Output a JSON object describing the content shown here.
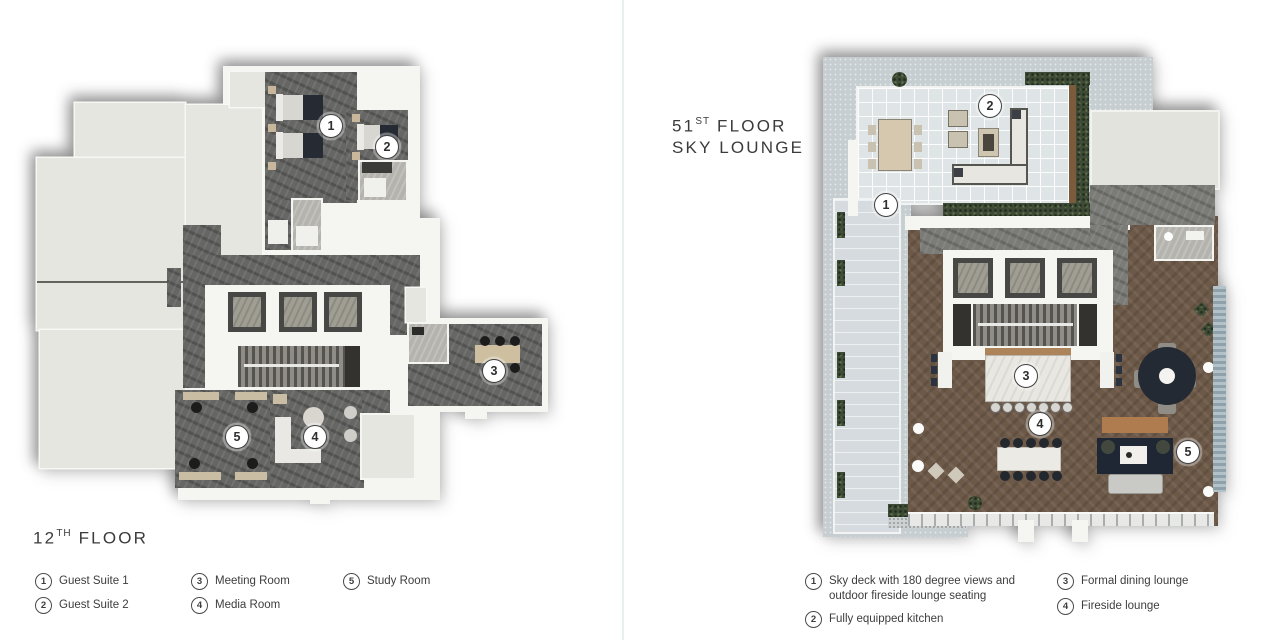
{
  "left_plan": {
    "title": {
      "number": "12",
      "ordinal": "TH",
      "word": "FLOOR"
    },
    "legend": [
      {
        "num": "1",
        "label": "Guest Suite 1"
      },
      {
        "num": "2",
        "label": "Guest Suite 2"
      },
      {
        "num": "3",
        "label": "Meeting Room"
      },
      {
        "num": "4",
        "label": "Media Room"
      },
      {
        "num": "5",
        "label": "Study Room"
      }
    ],
    "markers": [
      "1",
      "2",
      "3",
      "4",
      "5"
    ]
  },
  "right_plan": {
    "title": {
      "number": "51",
      "ordinal": "ST",
      "word": "FLOOR",
      "line2": "SKY LOUNGE"
    },
    "legend": [
      {
        "num": "1",
        "label": "Sky deck with 180 degree views and outdoor fireside lounge seating"
      },
      {
        "num": "2",
        "label": "Fully equipped kitchen"
      },
      {
        "num": "3",
        "label": "Formal dining lounge"
      },
      {
        "num": "4",
        "label": "Fireside lounge"
      }
    ],
    "markers": [
      "1",
      "2",
      "3",
      "4",
      "5"
    ]
  },
  "colors": {
    "marble": "#666664",
    "wood_floor": "#6d5948",
    "deck": "#c7ced1",
    "patio_tile": "#dfe5e7",
    "hedge": "#3f4b37",
    "unit_area": "#e5e6e0",
    "wall": "#f5f5f1",
    "text": "#3b3b3b"
  }
}
